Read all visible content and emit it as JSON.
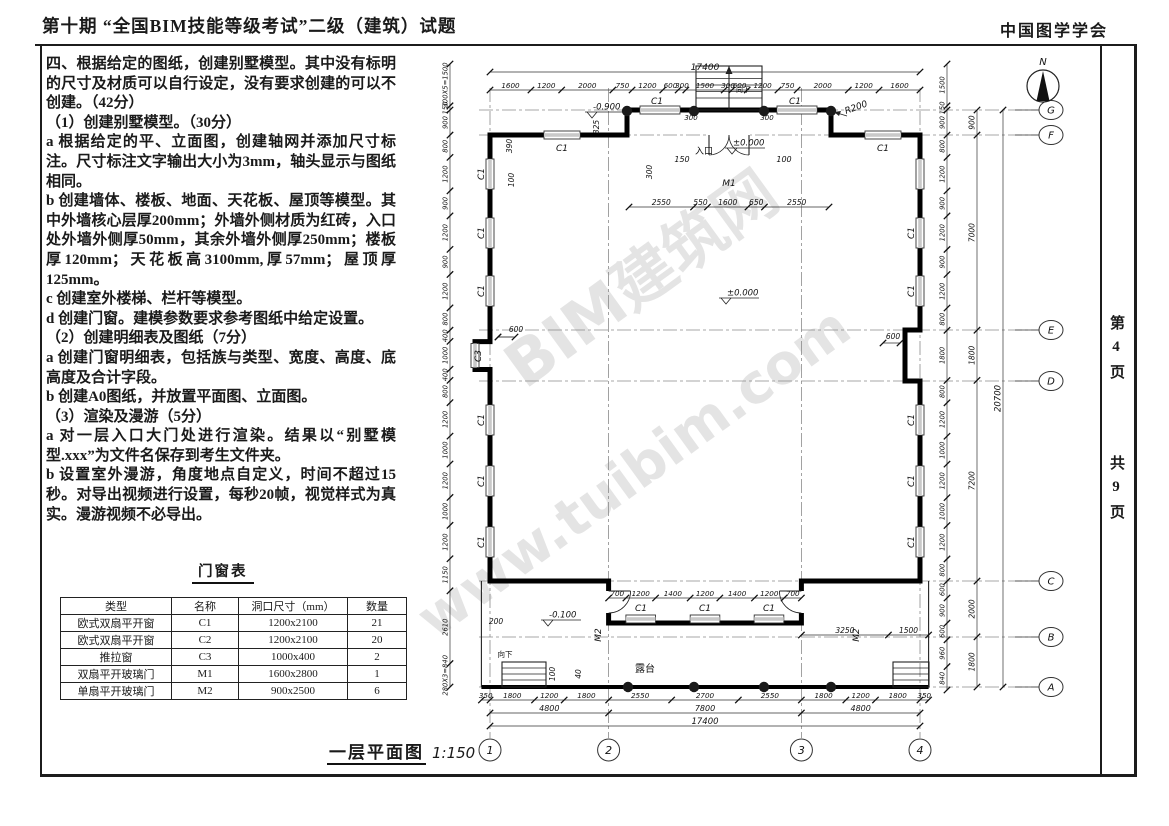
{
  "header": {
    "title_left": "第十期 “全国BIM技能等级考试”二级（建筑）试题",
    "title_right": "中国图学学会"
  },
  "sidebar": {
    "page_label": "第4页",
    "total_label": "共9页"
  },
  "questions": {
    "paragraphs": [
      "四、根据给定的图纸，创建别墅模型。其中没有标明的尺寸及材质可以自行设定，没有要求创建的可以不创建。（42分）",
      "（1）创建别墅模型。（30分）",
      "a 根据给定的平、立面图，创建轴网并添加尺寸标注。尺寸标注文字输出大小为3mm，轴头显示与图纸相同。",
      "b 创建墙体、楼板、地面、天花板、屋顶等模型。其中外墙核心层厚200mm；外墙外侧材质为红砖，入口处外墙外侧厚50mm，其余外墙外侧厚250mm；楼板厚120mm；天花板高3100mm,厚57mm；屋顶厚125mm。",
      "c 创建室外楼梯、栏杆等模型。",
      "d 创建门窗。建模参数要求参考图纸中给定设置。",
      "（2）创建明细表及图纸（7分）",
      "a 创建门窗明细表，包括族与类型、宽度、高度、底高度及合计字段。",
      "b 创建A0图纸，并放置平面图、立面图。",
      "（3）渲染及漫游（5分）",
      "a 对一层入口大门处进行渲染。结果以“别墅模型.xxx”为文件名保存到考生文件夹。",
      "b 设置室外漫游，角度地点自定义，时间不超过15秒。对导出视频进行设置，每秒20帧，视觉样式为真实。漫游视频不必导出。"
    ]
  },
  "schedule": {
    "title": "门窗表",
    "headers": [
      "类型",
      "名称",
      "洞口尺寸（mm）",
      "数量"
    ],
    "rows": [
      [
        "欧式双扇平开窗",
        "C1",
        "1200x2100",
        "21"
      ],
      [
        "欧式双扇平开窗",
        "C2",
        "1200x2100",
        "20"
      ],
      [
        "推拉窗",
        "C3",
        "1000x400",
        "2"
      ],
      [
        "双扇平开玻璃门",
        "M1",
        "1600x2800",
        "1"
      ],
      [
        "单扇平开玻璃门",
        "M2",
        "900x2500",
        "6"
      ]
    ]
  },
  "plan": {
    "title": "一层平面图",
    "scale": "1:150",
    "north_label": "N",
    "grid_cols": [
      "1",
      "2",
      "3",
      "4"
    ],
    "grid_rows": [
      "G",
      "F",
      "E",
      "D",
      "C",
      "B",
      "A"
    ],
    "dim_top_overall": "17400",
    "dim_top_segments": [
      "1600",
      "1200",
      "2000",
      "750",
      "1200",
      "600",
      "300",
      "1500",
      "300",
      "600",
      "1200",
      "750",
      "2000",
      "1200",
      "1600"
    ],
    "dim_entry_row": [
      "2550",
      "550",
      "1600",
      "650",
      "2550"
    ],
    "dim_porch": [
      "700",
      "1200",
      "1400",
      "1200",
      "1400",
      "1200",
      "700"
    ],
    "dim_terrace_right": [
      "3250",
      "1500"
    ],
    "dim_bottom_segments": [
      "350",
      "1800",
      "1200",
      "1800",
      "2550",
      "2700",
      "2550",
      "1800",
      "1200",
      "1800",
      "350"
    ],
    "dim_bottom_bays": [
      "4800",
      "7800",
      "4800"
    ],
    "dim_bottom_overall": "17400",
    "dim_left": [
      "300X5=1500",
      "150",
      "900",
      "800",
      "1200",
      "900",
      "1200",
      "900",
      "1200",
      "800",
      "400",
      "1000",
      "400",
      "800",
      "1200",
      "1000",
      "1200",
      "1000",
      "1200",
      "1150",
      "2610",
      "280X3=840"
    ],
    "dim_right_inner": [
      "1500",
      "150",
      "900",
      "800",
      "1200",
      "900",
      "1200",
      "900",
      "1200",
      "800",
      "1800",
      "800",
      "1200",
      "1000",
      "1200",
      "1000",
      "1200",
      "800",
      "600",
      "900",
      "600",
      "960",
      "840"
    ],
    "dim_right_bays": [
      "900",
      "7000",
      "1800",
      "7200",
      "2000",
      "1800"
    ],
    "dim_right_overall": "20700",
    "levels": [
      {
        "text": "-0.900",
        "x": 196,
        "y": 62
      },
      {
        "text": "±0.000",
        "x": 336,
        "y": 98
      },
      {
        "text": "±0.000",
        "x": 330,
        "y": 248
      },
      {
        "text": "-0.100",
        "x": 152,
        "y": 570
      }
    ],
    "annotations": [
      {
        "t": "C1",
        "x": 167,
        "y": 101,
        "r": 0,
        "fs": 9
      },
      {
        "t": "C1",
        "x": 262,
        "y": 54,
        "r": 0,
        "fs": 9
      },
      {
        "t": "C1",
        "x": 400,
        "y": 54,
        "r": 0,
        "fs": 9
      },
      {
        "t": "C1",
        "x": 488,
        "y": 101,
        "r": 0,
        "fs": 9
      },
      {
        "t": "向下",
        "x": 348,
        "y": 42,
        "r": 0,
        "fs": 7
      },
      {
        "t": "入口",
        "x": 309,
        "y": 104,
        "r": 0,
        "fs": 9
      },
      {
        "t": "M1",
        "x": 334,
        "y": 136,
        "r": 0,
        "fs": 9
      },
      {
        "t": "150",
        "x": 287,
        "y": 112,
        "r": 0,
        "fs": 8
      },
      {
        "t": "100",
        "x": 389,
        "y": 112,
        "r": 0,
        "fs": 8
      },
      {
        "t": "300",
        "x": 257,
        "y": 122,
        "r": -90,
        "fs": 7.5
      },
      {
        "t": "325",
        "x": 204,
        "y": 77,
        "r": -90,
        "fs": 7.5
      },
      {
        "t": "390",
        "x": 117,
        "y": 96,
        "r": -90,
        "fs": 7.5
      },
      {
        "t": "100",
        "x": 119,
        "y": 130,
        "r": -90,
        "fs": 7.5
      },
      {
        "t": "R200",
        "x": 462,
        "y": 60,
        "r": -20,
        "fs": 9
      },
      {
        "t": "600",
        "x": 121,
        "y": 282,
        "r": 0,
        "fs": 7.5
      },
      {
        "t": "600",
        "x": 498,
        "y": 289,
        "r": 0,
        "fs": 7.5
      },
      {
        "t": "C3",
        "x": 86,
        "y": 306,
        "r": -90,
        "fs": 9
      },
      {
        "t": "C1",
        "x": 89,
        "y": 124,
        "r": -90,
        "fs": 9
      },
      {
        "t": "C1",
        "x": 89,
        "y": 183,
        "r": -90,
        "fs": 9
      },
      {
        "t": "C1",
        "x": 89,
        "y": 241,
        "r": -90,
        "fs": 9
      },
      {
        "t": "C1",
        "x": 89,
        "y": 370,
        "r": -90,
        "fs": 9
      },
      {
        "t": "C1",
        "x": 89,
        "y": 431,
        "r": -90,
        "fs": 9
      },
      {
        "t": "C1",
        "x": 89,
        "y": 492,
        "r": -90,
        "fs": 9
      },
      {
        "t": "C1",
        "x": 519,
        "y": 183,
        "r": -90,
        "fs": 9
      },
      {
        "t": "C1",
        "x": 519,
        "y": 241,
        "r": -90,
        "fs": 9
      },
      {
        "t": "C1",
        "x": 519,
        "y": 370,
        "r": -90,
        "fs": 9
      },
      {
        "t": "C1",
        "x": 519,
        "y": 431,
        "r": -90,
        "fs": 9
      },
      {
        "t": "C1",
        "x": 519,
        "y": 492,
        "r": -90,
        "fs": 9
      },
      {
        "t": "C1",
        "x": 246,
        "y": 561,
        "r": 0,
        "fs": 9
      },
      {
        "t": "C1",
        "x": 310,
        "y": 561,
        "r": 0,
        "fs": 9
      },
      {
        "t": "C1",
        "x": 374,
        "y": 561,
        "r": 0,
        "fs": 9
      },
      {
        "t": "M2",
        "x": 206,
        "y": 585,
        "r": -90,
        "fs": 9
      },
      {
        "t": "M2",
        "x": 464,
        "y": 585,
        "r": -90,
        "fs": 9
      },
      {
        "t": "露台",
        "x": 250,
        "y": 622,
        "r": 0,
        "fs": 10
      },
      {
        "t": "向下",
        "x": 110,
        "y": 607,
        "r": 0,
        "fs": 7.5
      },
      {
        "t": "200",
        "x": 101,
        "y": 574,
        "r": 0,
        "fs": 7.5
      },
      {
        "t": "100",
        "x": 160,
        "y": 624,
        "r": -90,
        "fs": 7.5
      },
      {
        "t": "40",
        "x": 186,
        "y": 624,
        "r": -90,
        "fs": 7.5
      },
      {
        "t": "300",
        "x": 296,
        "y": 70,
        "r": 0,
        "fs": 7
      },
      {
        "t": "300",
        "x": 372,
        "y": 70,
        "r": 0,
        "fs": 7
      }
    ],
    "watermark_lines": [
      "BIM建筑网",
      "www.tuibim.com"
    ]
  }
}
